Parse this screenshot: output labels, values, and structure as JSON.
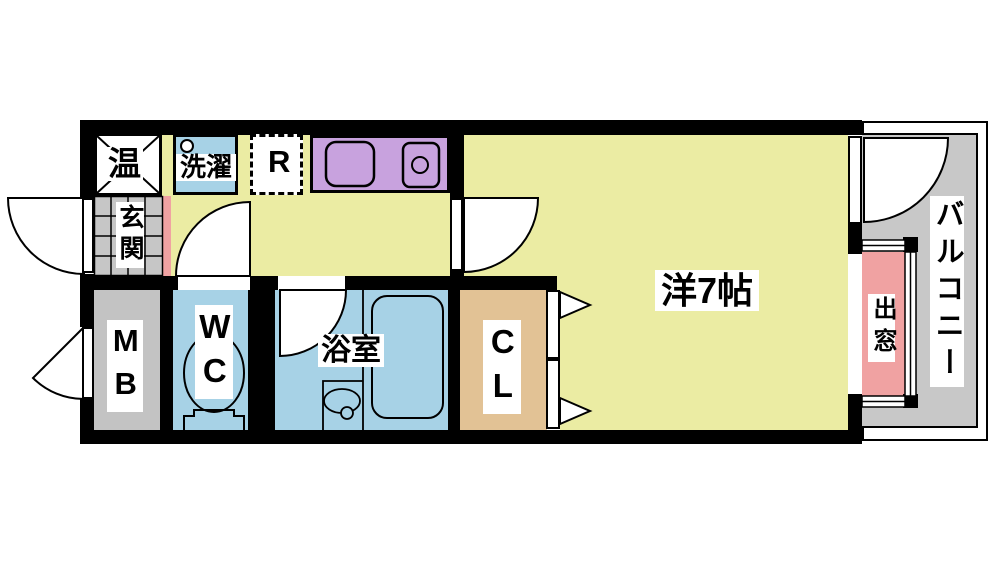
{
  "title": "1K apartment floor plan",
  "labels": {
    "water_heater": "温",
    "entrance": "玄関",
    "laundry": "洗濯",
    "refrigerator": "R",
    "meter_box": "MB",
    "toilet": "WC",
    "bathroom": "浴室",
    "closet": "CL",
    "western_room": "洋7帖",
    "bay_window": "出窓",
    "balcony": "バルコニー"
  },
  "colors": {
    "room-yellow": "#ebeca3",
    "kitchen-purple": "#c8a2de",
    "wet-blue": "#a7d2e6",
    "closet-tan": "#e2c295",
    "window-pink": "#f0a2a2",
    "balcony-gray": "#c8c8c8",
    "tile-gray": "#c6c6c6",
    "mb-gray": "#c3c3c3",
    "wall-black": "#000000"
  }
}
